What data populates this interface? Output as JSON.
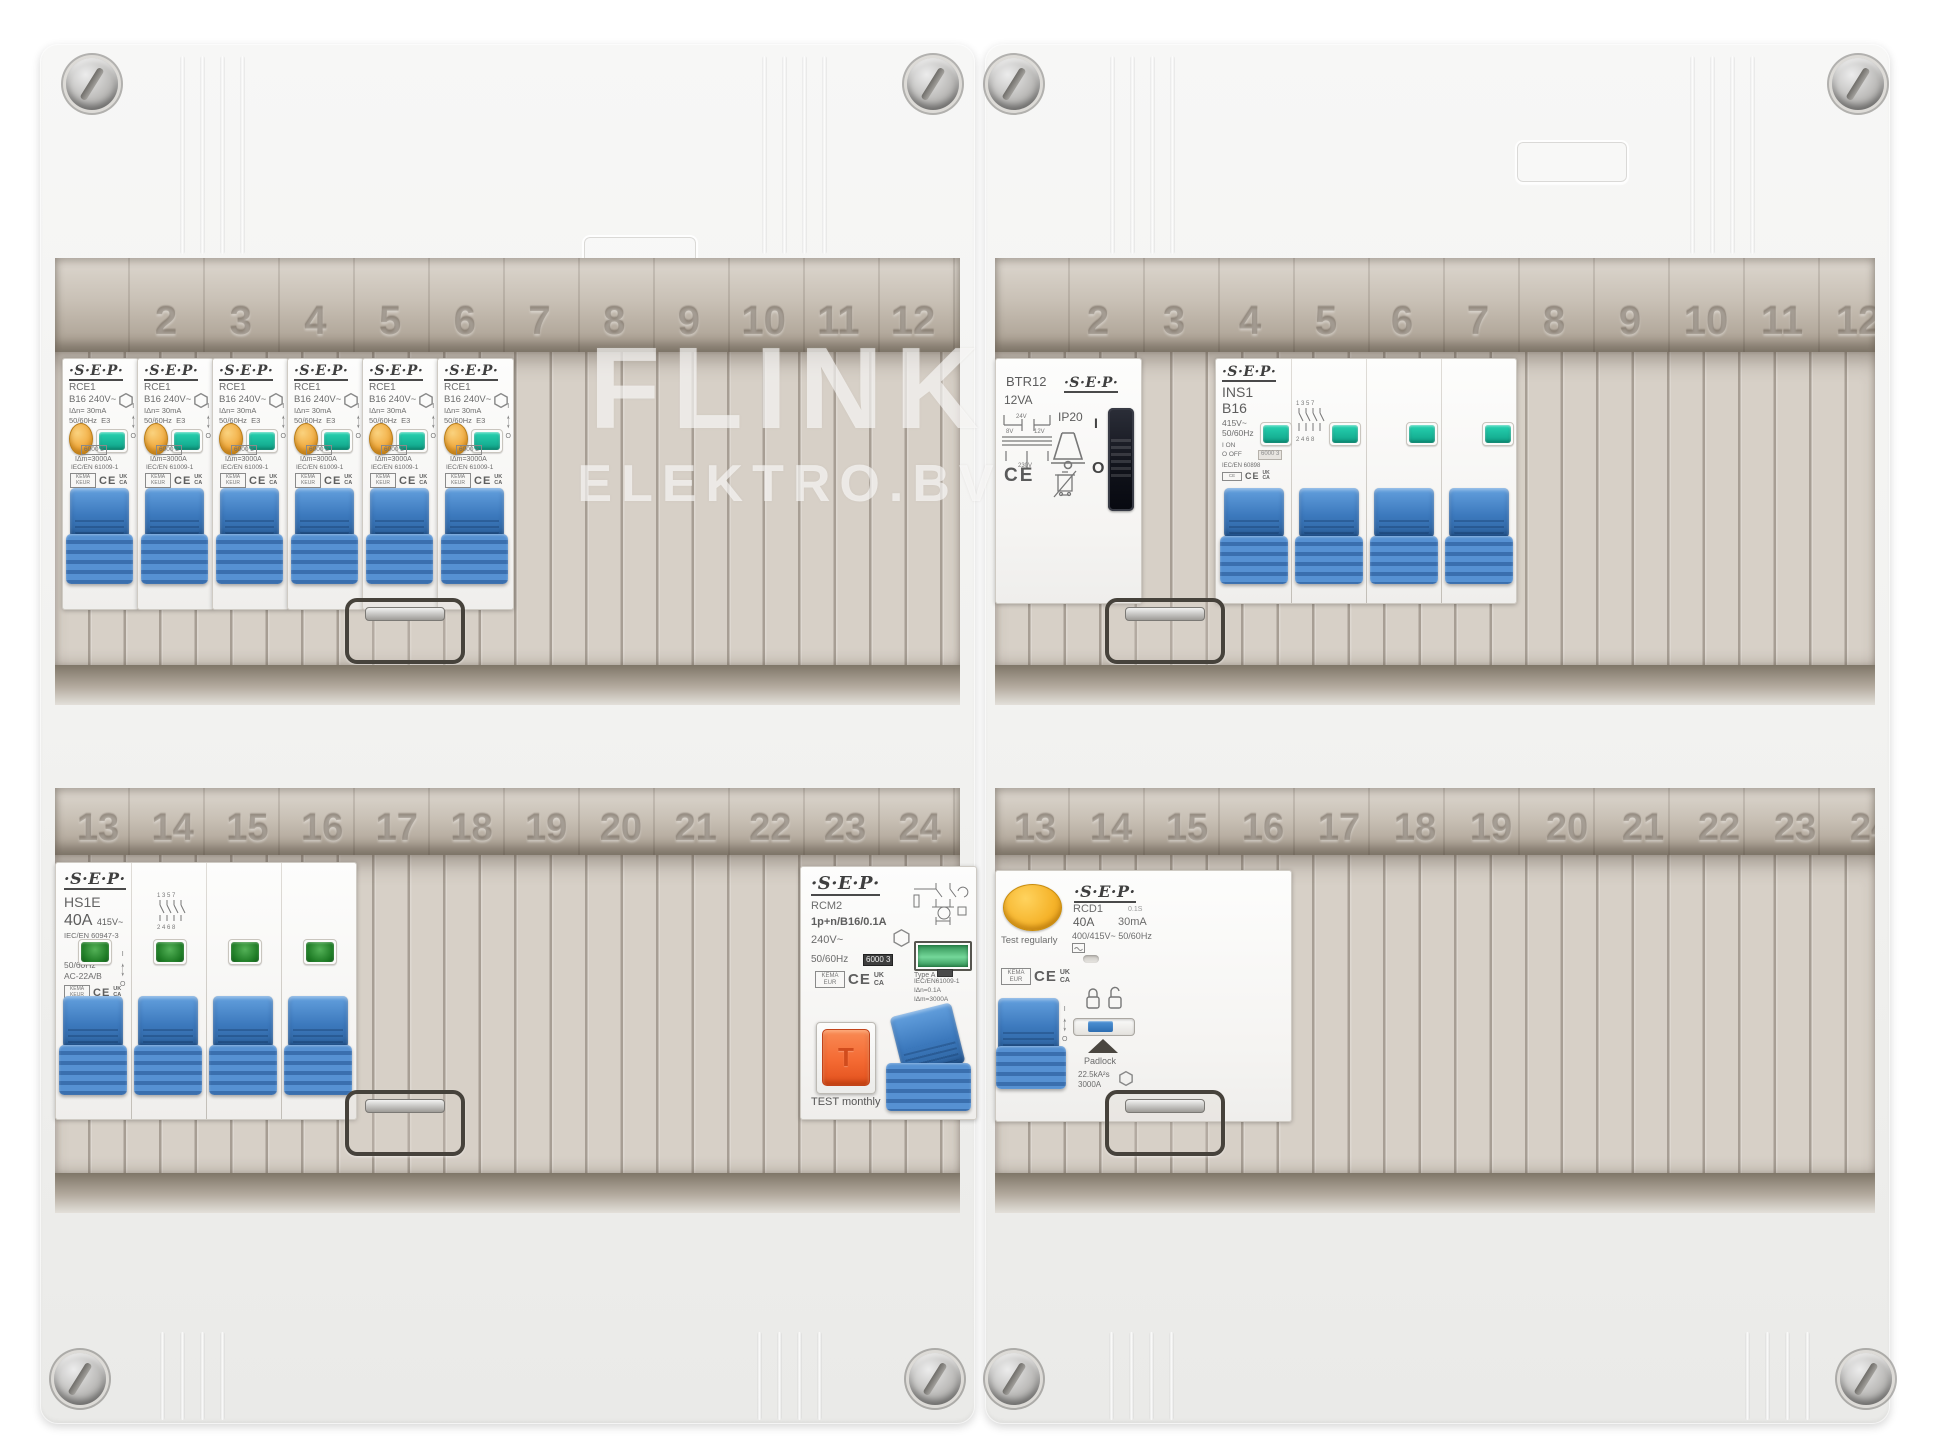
{
  "watermark": {
    "line1": "FLINK",
    "line2": "ELEKTRO.BV"
  },
  "rails": {
    "top": [
      "2",
      "3",
      "4",
      "5",
      "6",
      "7",
      "8",
      "9",
      "10",
      "11",
      "12"
    ],
    "bottom": [
      "13",
      "14",
      "15",
      "16",
      "17",
      "18",
      "19",
      "20",
      "21",
      "22",
      "23",
      "24"
    ]
  },
  "rce1": {
    "brand": "·S·E·P·",
    "model": "RCE1",
    "rating": "B16  240V~",
    "idn": "IΔn= 30mA",
    "freq": "50/60Hz",
    "cls": "E3",
    "breaking_box": "6000 3",
    "idm": "IΔm=3000A",
    "standard": "IEC/EN 61009-1",
    "cert": "KEMA KEUR",
    "ce": "CE",
    "uk": "UK",
    "ca": "CA",
    "on": "I",
    "off": "O"
  },
  "hs1e": {
    "brand": "·S·E·P·",
    "model": "HS1E",
    "amps": "40A",
    "volts": "415V~",
    "standard": "IEC/EN 60947-3",
    "freq": "50/60Hz",
    "util": "AC-22A/B",
    "cert": "KEMA KEUR",
    "ce": "CE",
    "uk": "UK",
    "ca": "CA",
    "on": "I",
    "off": "O",
    "diag_top": "1 3 5 7",
    "diag_bottom": "2 4 6 8"
  },
  "rcm2": {
    "brand": "·S·E·P·",
    "model": "RCM2",
    "spec": "1p+n/B16/0.1A",
    "volts": "240V~",
    "freq": "50/60Hz",
    "breaking_box": "6000 3",
    "type_label": "Type A",
    "standard": "IEC/EN61009-1",
    "idn": "IΔn=0.1A",
    "idm": "IΔm=3000A",
    "cert": "KEMA EUR",
    "ce": "CE",
    "uk": "UK",
    "ca": "CA",
    "test_button": "T",
    "test_label": "TEST monthly"
  },
  "btr12": {
    "model": "BTR12",
    "va": "12VA",
    "brand": "·S·E·P·",
    "ip": "IP20",
    "v24": "24V",
    "v8": "8V",
    "v12": "12V",
    "v230": "230V",
    "on": "I",
    "off": "O",
    "ce": "CE"
  },
  "ins1": {
    "brand": "·S·E·P·",
    "model": "INS1",
    "rating": "B16",
    "volts": "415V~",
    "freq": "50/60Hz",
    "on_label": "I ON",
    "off_label": "O OFF",
    "box": "6000 3",
    "standard": "IEC/EN 60898",
    "ce": "CE",
    "uk": "UK",
    "ca": "CA",
    "diag_top": "1 3 5 7",
    "diag_bottom": "2 4 6 8"
  },
  "rcd1": {
    "brand": "·S·E·P·",
    "model": "RCD1",
    "delay": "0.1S",
    "amps": "40A",
    "ma": "30mA",
    "volts": "400/415V~  50/60Hz",
    "test_label": "Test regularly",
    "cert": "KEMA EUR",
    "ce": "CE",
    "uk": "UK",
    "ca": "CA",
    "on": "I",
    "off": "O",
    "padlock": "Padlock",
    "ka": "22.5kA²s",
    "a3000": "3000A"
  },
  "colors": {
    "toggle_blue": "#3c79bd",
    "teal_window": "#14bfa0",
    "green_window": "#1d7a24",
    "test_orange": "#f1aa3e",
    "test_red_orange": "#f46a33",
    "test_yellow": "#f5b32a",
    "blank_cover": "#d7d0c7",
    "rail_strip": "#b4a99b",
    "cabinet": "#f1f1ef"
  }
}
